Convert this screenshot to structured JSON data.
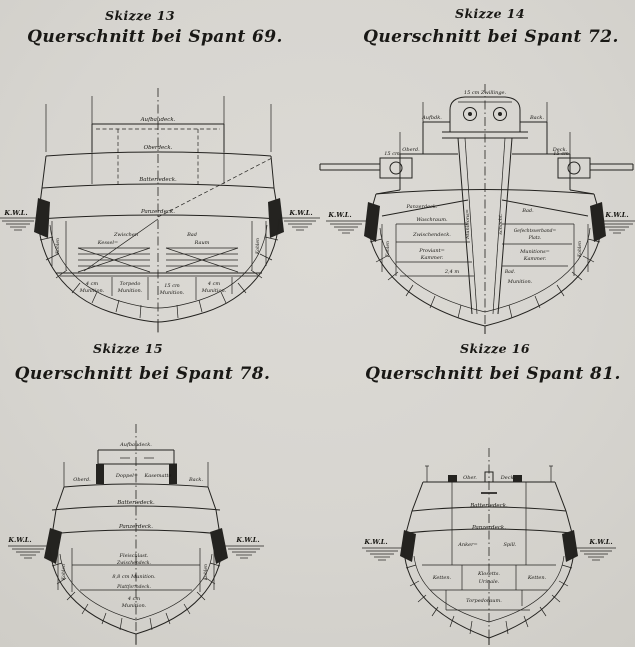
{
  "page": {
    "background": "#d8d6d1",
    "ink": "#1f1e1c"
  },
  "s13": {
    "skizze": "Skizze 13",
    "caption": "Querschnitt bei Spant 69.",
    "deck_aufbau": "Aufbaudeck.",
    "deck_ober": "Oberdeck.",
    "deck_batterie": "Batteriedeck.",
    "deck_panzer": "Panzerdeck.",
    "room_zwischen": "Zwischen",
    "room_kessel": "Kessel=",
    "room_bad": "Bad",
    "room_raum": "Raum",
    "mag1_l1": "4 cm",
    "mag1_l2": "Munition.",
    "mag2_l1": "Torpedo",
    "mag2_l2": "Munition.",
    "mag3_l1": "15 cm",
    "mag3_l2": "Munition.",
    "mag4_l1": "4 cm",
    "mag4_l2": "Munition.",
    "coal": "Kohlen",
    "wl_left": "K.W.L.",
    "wl_right": "K.W.L."
  },
  "s14": {
    "skizze": "Skizze 14",
    "caption": "Querschnitt bei Spant 72.",
    "turret": "15 cm Zwillinge.",
    "gun_left": "15 cm",
    "gun_right": "15 cm",
    "deck_aufbau_l": "Aufbdk.",
    "deck_aufbau_r": "Back.",
    "deck_ober_l": "Oberd.",
    "deck_ober_r": "Deck.",
    "deck_panzer": "Panzerdeck.",
    "trunk_l": "Munitions=",
    "trunk_r": "schacht.",
    "room_wasch": "Waschraum.",
    "room_zwischen": "Zwischendeck.",
    "room_prov1": "Proviant=",
    "room_prov2": "Kammer.",
    "note_depth": "2,4 m",
    "room_bad_top": "Bad.",
    "room_gefecht1": "Gefechtsverband=",
    "room_gefecht2": "Platz.",
    "room_mun1": "Munitions=",
    "room_mun2": "Kammer.",
    "room_bad_small": "Bad.",
    "room_munition": "Munition.",
    "coal": "Kohlen",
    "wl_left": "K.W.L.",
    "wl_right": "K.W.L."
  },
  "s15": {
    "skizze": "Skizze 15",
    "caption": "Querschnitt bei Spant 78.",
    "deck_aufbau": "Aufbaudeck.",
    "kasematte1": "Doppel=",
    "kasematte2": "Kasematte",
    "deck_ober": "Oberd.",
    "deck_back": "Back.",
    "deck_batterie": "Batteriedeck.",
    "deck_panzer": "Panzerdeck.",
    "room_fleisch": "Fleischlast.",
    "deck_zwischen": "Zwischendeck.",
    "room_mag1": "8,8 cm Munition.",
    "deck_plattform": "Plattformdeck.",
    "room_mag2_l1": "4 cm",
    "room_mag2_l2": "Munition.",
    "coal": "Kohlen",
    "wl_left": "K.W.L.",
    "wl_right": "K.W.L."
  },
  "s16": {
    "skizze": "Skizze 16",
    "caption": "Querschnitt bei Spant 81.",
    "deck_ober_l": "Ober.",
    "deck_ober_r": "Deck.",
    "deck_batterie": "Batteriedeck.",
    "deck_panzer": "Panzerdeck.",
    "room_anker1": "Anker=",
    "room_anker2": "Spill.",
    "room_ketten_l": "Ketten.",
    "room_ketten_r": "Ketten.",
    "room_klosetts": "Klosetts.",
    "room_urinale": "Urinale.",
    "room_torpedo": "Torpedoraum.",
    "wl_left": "K.W.L.",
    "wl_right": "K.W.L."
  }
}
